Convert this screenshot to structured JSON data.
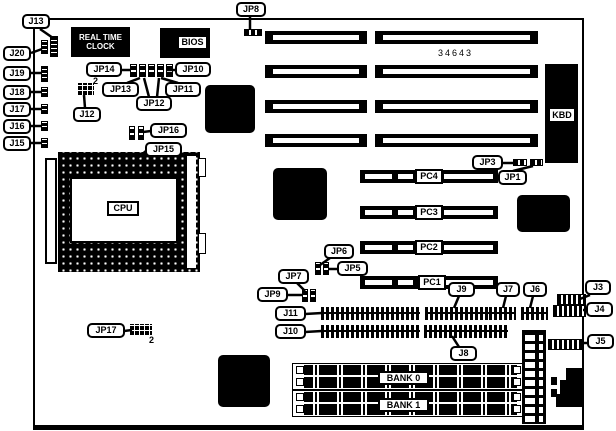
{
  "board": {
    "part_number": "34643",
    "components": {
      "rtc_line1": "REAL TIME",
      "rtc_line2": "CLOCK",
      "bios": "BIOS",
      "cpu": "CPU",
      "kbd": "KBD"
    },
    "expansion_slots": {
      "pc1": "PC1",
      "pc2": "PC2",
      "pc3": "PC3",
      "pc4": "PC4"
    },
    "memory_banks": {
      "bank0": "BANK 0",
      "bank1": "BANK 1"
    },
    "jumpers": {
      "jp1": "JP1",
      "jp3": "JP3",
      "jp5": "JP5",
      "jp6": "JP6",
      "jp7": "JP7",
      "jp8": "JP8",
      "jp9": "JP9",
      "jp10": "JP10",
      "jp11": "JP11",
      "jp12": "JP12",
      "jp13": "JP13",
      "jp14": "JP14",
      "jp15": "JP15",
      "jp16": "JP16",
      "jp17": "JP17"
    },
    "connectors": {
      "j3": "J3",
      "j4": "J4",
      "j5": "J5",
      "j6": "J6",
      "j7": "J7",
      "j8": "J8",
      "j9": "J9",
      "j10": "J10",
      "j11": "J11",
      "j12": "J12",
      "j13": "J13",
      "j15": "J15",
      "j16": "J16",
      "j17": "J17",
      "j18": "J18",
      "j19": "J19",
      "j20": "J20"
    },
    "pin_markers": {
      "j12_pin2": "2",
      "jp17_pin2": "2"
    }
  }
}
